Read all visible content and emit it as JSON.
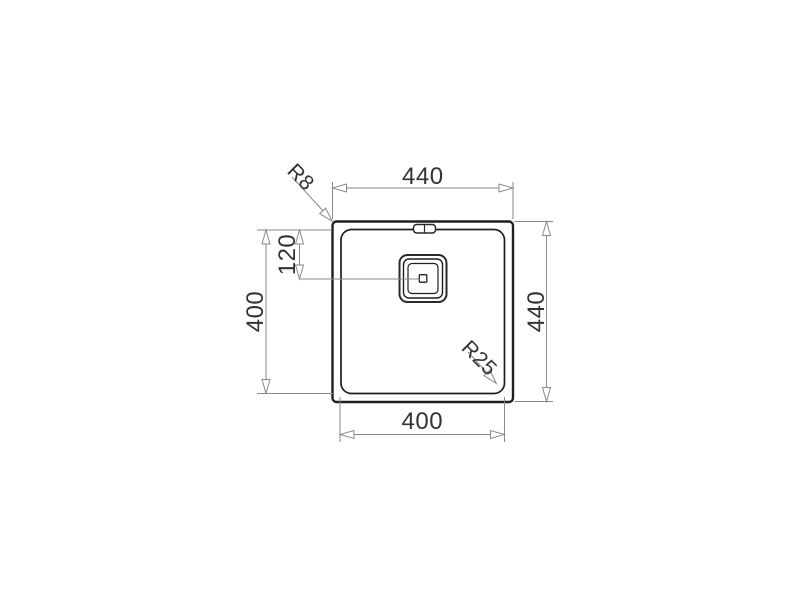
{
  "drawing": {
    "labels": {
      "outer_width": "440",
      "outer_height": "440",
      "bowl_height": "400",
      "bowl_width": "400",
      "drain_center_from_top": "120",
      "outer_corner_radius": "R8",
      "bowl_corner_radius": "R25"
    },
    "colors": {
      "background": "#ffffff",
      "object_line": "#1f1f1f",
      "dimension_line": "#8a8a8a",
      "label_text": "#333333"
    }
  }
}
